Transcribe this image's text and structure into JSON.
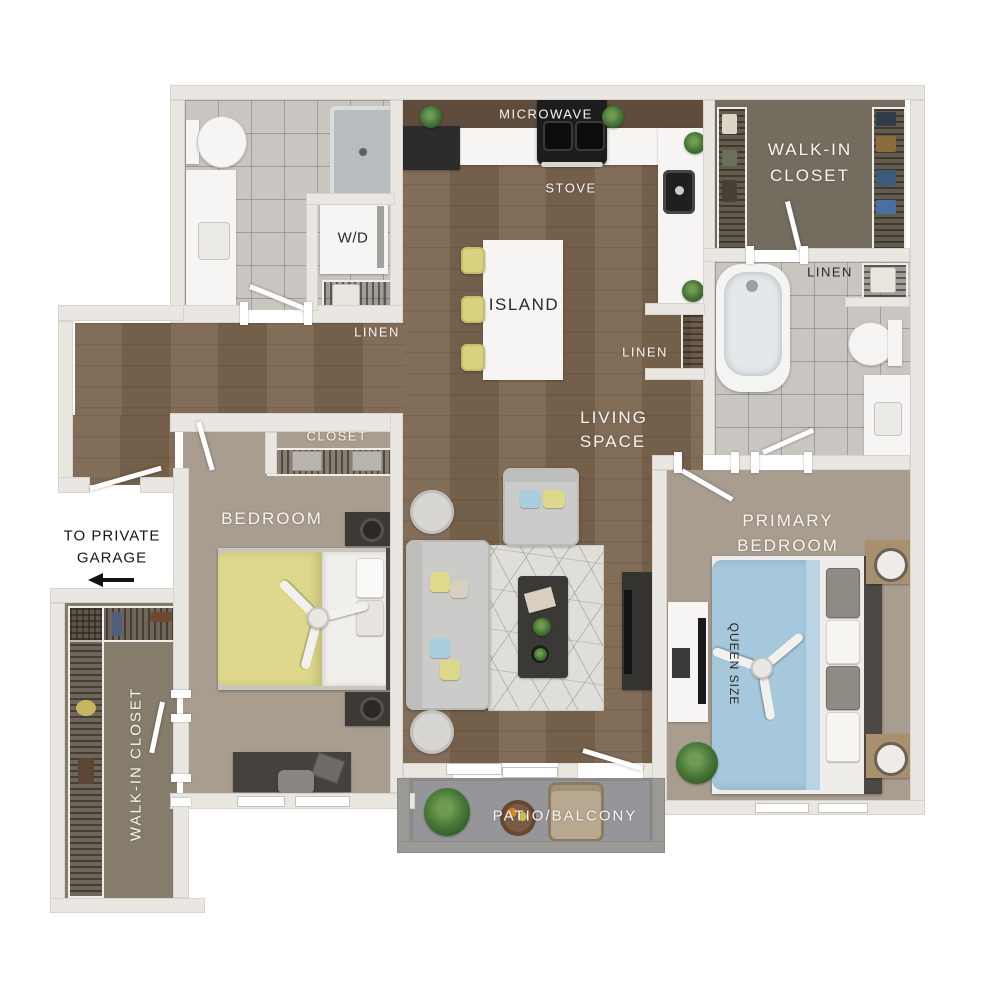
{
  "rooms": {
    "kitchen": {
      "microwave": "MICROWAVE",
      "stove": "STOVE",
      "island": "ISLAND"
    },
    "laundry": {
      "washer_dryer": "W/D",
      "linen": "LINEN"
    },
    "hall_closet": {
      "linen": "LINEN"
    },
    "primary_bath": {
      "linen": "LINEN"
    },
    "walk_in_closet_top": {
      "line1": "WALK-IN",
      "line2": "CLOSET"
    },
    "living": {
      "line1": "LIVING",
      "line2": "SPACE"
    },
    "bedroom": {
      "name": "BEDROOM",
      "closet": "CLOSET"
    },
    "primary_bedroom": {
      "line1": "PRIMARY",
      "line2": "BEDROOM",
      "bed_size": "QUEEN SIZE"
    },
    "entry": {
      "line1": "TO PRIVATE",
      "line2": "GARAGE"
    },
    "walk_in_closet_left": {
      "name": "WALK-IN CLOSET"
    },
    "patio": {
      "name": "PATIO/BALCONY"
    }
  },
  "icons": {
    "garage_arrow": "left-arrow",
    "bedroom_fan": "ceiling-fan",
    "primary_fan": "ceiling-fan"
  },
  "colors": {
    "wood_floor": "#7b654f",
    "tile_floor": "#c9c6c1",
    "carpet": "#a89d8f",
    "closet_floor": "#746c5e",
    "patio_floor": "#96969a",
    "wall": "#eae7e3",
    "accent_yellow": "#ddd88b",
    "accent_blue": "#a5c8dc",
    "label_light": "#f8f6f2",
    "label_dark": "#2b2927",
    "plant_green": "#4c7d3a"
  }
}
